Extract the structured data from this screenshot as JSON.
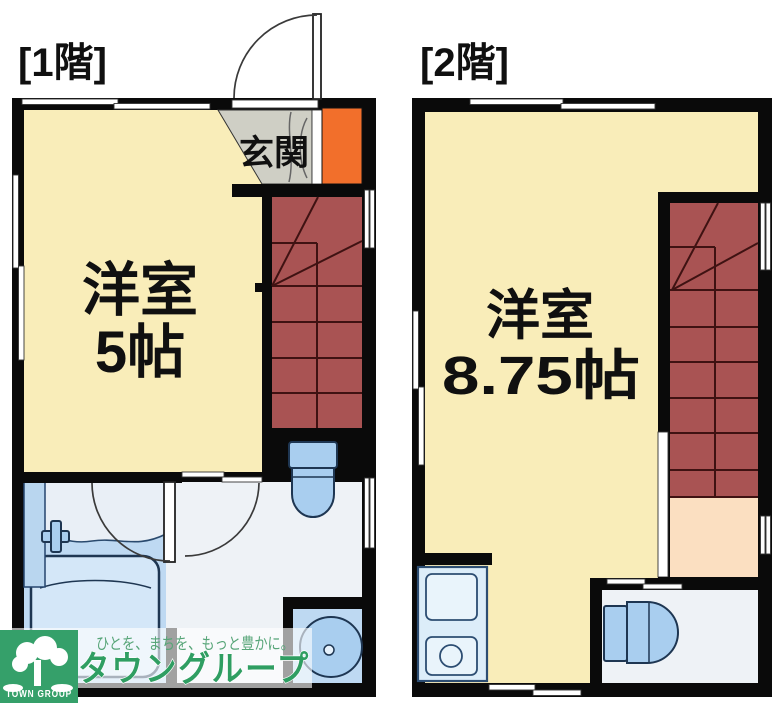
{
  "floor1": {
    "label": "[1階]",
    "entrance_label": "玄関",
    "room_label": "洋室",
    "room_size": "5帖"
  },
  "floor2": {
    "label": "[2階]",
    "room_label": "洋室",
    "room_size": "8.75帖"
  },
  "watermark": {
    "tagline": "ひとを、まちを、もっと豊かに。",
    "brand": "タウングループ",
    "logo_text": "TOWN GROUP"
  },
  "colors": {
    "wall": "#0a0a0a",
    "cream": "#f9edb9",
    "stair": "#a95353",
    "tread": "#3f1212",
    "orange": "#f26f2b",
    "genkan_gray": "#cfcfc5",
    "peach": "#fbdfc1",
    "fixture_blue": "#a9ceef",
    "light_blue": "#bed9f2",
    "floor_light": "#eef2f6",
    "kitchen_fill": "#dcedf9",
    "logo_green": "#35a06a",
    "brand_green": "#2f9e62",
    "tagline_green": "#57a578"
  }
}
